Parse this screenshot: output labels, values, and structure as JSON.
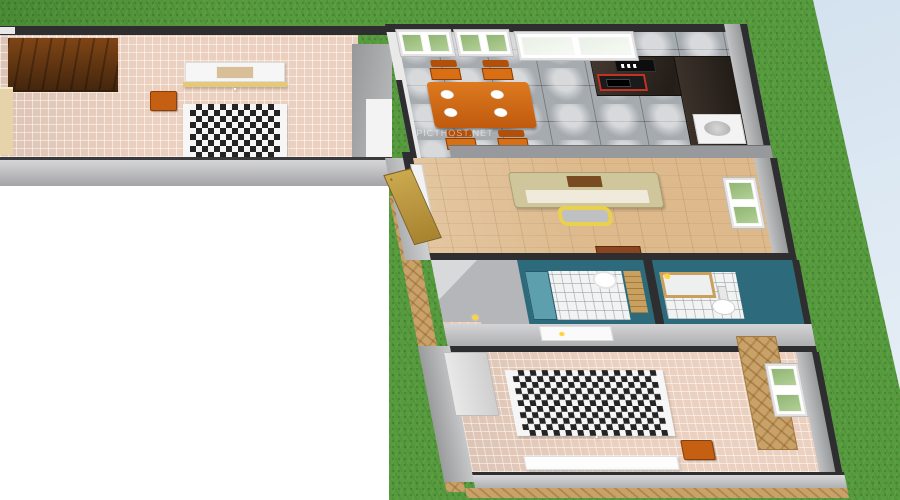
{
  "watermark": {
    "text": "PICTHOST.NET"
  },
  "scene": {
    "type": "3d-floor-plan-render",
    "rooms": [
      {
        "id": "bedroom-1",
        "label": "Bedroom 1",
        "floor": "pink-tile",
        "furniture": [
          "dark-parquet-panel",
          "side-cabinet",
          "nightstand",
          "double-bed-checkered-blanket"
        ]
      },
      {
        "id": "kitchen-dining",
        "label": "Kitchen / Dining",
        "floor": "glossy-gray-tile",
        "furniture": [
          "dining-table-orange",
          "chair",
          "chair",
          "chair",
          "chair",
          "plates",
          "dark-counter",
          "stove-red-trim",
          "microwave",
          "sink"
        ]
      },
      {
        "id": "living-room",
        "label": "Living Room",
        "floor": "light-wood",
        "furniture": [
          "sofa-beige",
          "coffee-table-yellow",
          "tv-cabinet",
          "front-door-gold-panels",
          "window"
        ]
      },
      {
        "id": "bathroom-1",
        "label": "Bathroom 1",
        "floor": "white-tile",
        "furniture": [
          "shower-glass",
          "round-sink",
          "wooden-door"
        ]
      },
      {
        "id": "bathroom-2",
        "label": "Bathroom 2",
        "floor": "white-tile",
        "furniture": [
          "bathtub-wood-edge",
          "toilet"
        ]
      },
      {
        "id": "bedroom-2",
        "label": "Bedroom 2",
        "floor": "pink-tile",
        "furniture": [
          "double-bed-checkered-blanket",
          "nightstand",
          "wardrobe-herringbone",
          "dresser",
          "wall-shelf-white",
          "window"
        ]
      }
    ],
    "environment": {
      "lawn": "green-grass",
      "backdrop_top_right": "pale-blue",
      "backdrop_bottom_left": "white",
      "terrace": "tan-herringbone-brick"
    }
  },
  "colors": {
    "sky_top": "#c7daea",
    "sky_bottom": "#eaf1f8",
    "white_bg": "#ffffff",
    "grass": "#569b3d",
    "wall_dark": "#2e2e30",
    "wall_white": "#f3f3f3",
    "floor_pink": "#ebd0bf",
    "floor_wood": "#ddb98b",
    "tile_gray": "#a6abb0",
    "teal": "#2d6b7c",
    "teal_light": "#5e9fae",
    "orange": "#c55f12",
    "table_orange": "#c05a0e",
    "red_stove": "#c23324",
    "cream": "#e7d3a9",
    "gold": "#e5c878",
    "checker": "#242424",
    "terrace": "#c8a268",
    "wood_door": "#c9a05e",
    "yellow": "#ffd23e",
    "yellow_table": "#ead04f",
    "sofa": "#cfc79b",
    "sofa_trim": "#a9a077",
    "tv_brown": "#8a4420"
  }
}
